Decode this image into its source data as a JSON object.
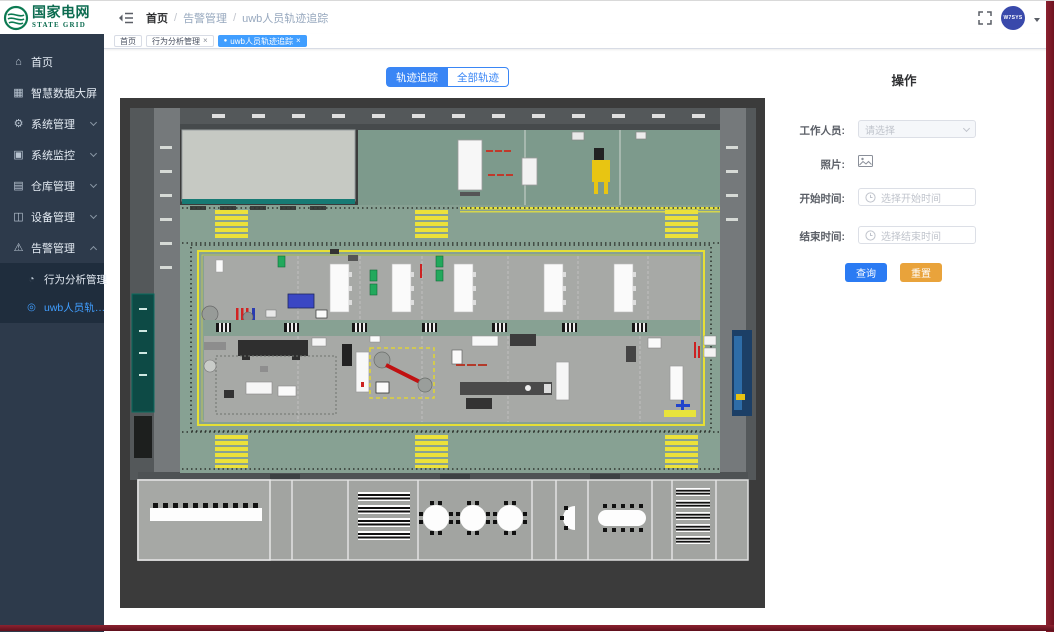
{
  "logo": {
    "title": "国家电网",
    "subtitle": "STATE GRID"
  },
  "sidebar": {
    "items": [
      {
        "label": "首页",
        "icon": "⌂"
      },
      {
        "label": "智慧数据大屏",
        "icon": "▦"
      },
      {
        "label": "系统管理",
        "icon": "⚙"
      },
      {
        "label": "系统监控",
        "icon": "▣"
      },
      {
        "label": "仓库管理",
        "icon": "▤"
      },
      {
        "label": "设备管理",
        "icon": "◫"
      },
      {
        "label": "告警管理",
        "icon": "⚠"
      }
    ],
    "submenu": [
      {
        "label": "行为分析管理",
        "icon": "◔"
      },
      {
        "label": "uwb人员轨…",
        "icon": "◎"
      }
    ]
  },
  "header": {
    "breadcrumb": [
      {
        "label": "首页"
      },
      {
        "label": "告警管理"
      },
      {
        "label": "uwb人员轨迹追踪"
      }
    ],
    "separator": "/",
    "avatar_text": "W7SYS"
  },
  "tabs": [
    {
      "label": "首页"
    },
    {
      "label": "行为分析管理"
    },
    {
      "label": "uwb人员轨迹追踪"
    }
  ],
  "glyphs": {
    "close": "×",
    "dot": "●"
  },
  "view_toggle": {
    "options": [
      {
        "label": "轨迹追踪"
      },
      {
        "label": "全部轨迹"
      }
    ]
  },
  "ops_panel": {
    "title": "操作",
    "fields": {
      "worker": {
        "label": "工作人员:",
        "placeholder": "请选择"
      },
      "photo": {
        "label": "照片:"
      },
      "start_time": {
        "label": "开始时间:",
        "placeholder": "选择开始时间"
      },
      "end_time": {
        "label": "结束时间:",
        "placeholder": "选择结束时间"
      }
    },
    "buttons": {
      "query": "查询",
      "reset": "重置"
    }
  },
  "colors": {
    "primary": "#3a86f5",
    "warning": "#e9a33b",
    "sidebar_bg": "#2d3a4b",
    "submenu_bg": "#1f2d3d",
    "active_link": "#409eff",
    "window_frame": "#7c1f2e",
    "map_background": "#3b3b3b",
    "map_floor_green": "#87a193",
    "map_zone_gray": "#a7a9a6",
    "map_marking_yellow": "#e8e33c"
  }
}
